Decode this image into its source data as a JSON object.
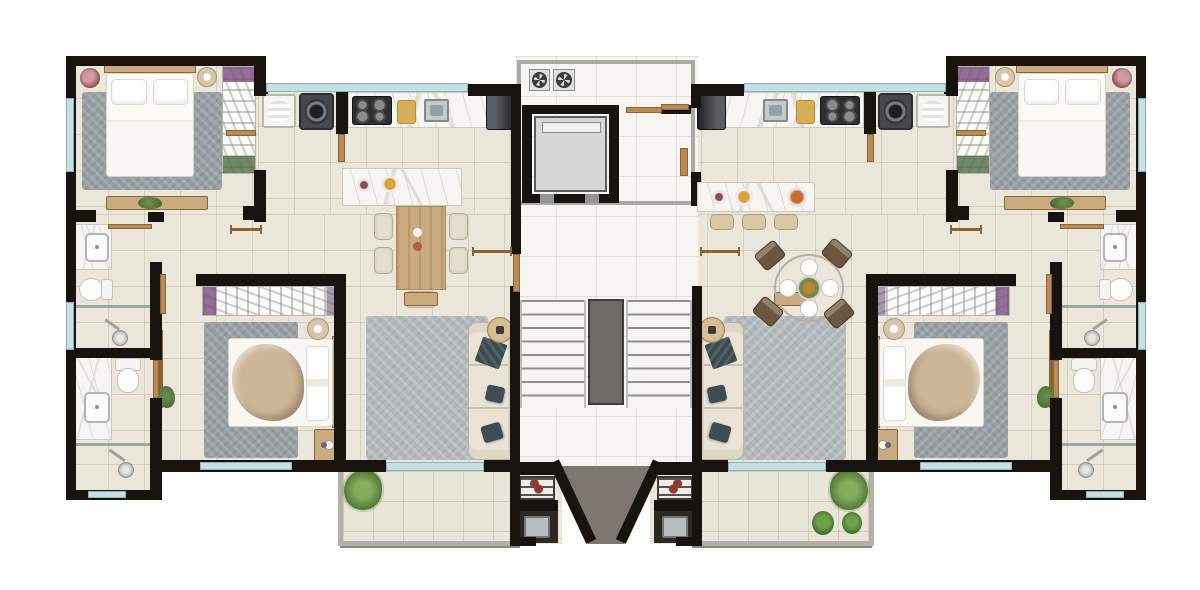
{
  "meta": {
    "canvas_w": 1200,
    "canvas_h": 590,
    "mirror_axis": 606,
    "description-data": "symmetric two-unit residential floor plan, central elevator and stair core"
  },
  "palette": {
    "wall": "#17140f",
    "floor": "#eae6da",
    "core": "#f6f5f2",
    "balc": "#e9e5d8",
    "balcFrame": "#b3b0aa",
    "window": "#c6dfe5",
    "windowFrame": "#8fb0b8",
    "wood": "#b88c54",
    "woodDark": "#8a6433",
    "woodLight": "#c9ab7f",
    "marble": "#f6f5f2",
    "marbleVein": "#d8d6d1",
    "rug": "#989ea1",
    "rugLight": "#b4b9bb",
    "sofa": "#e9e3d6",
    "pillowDark": "#3f4c51",
    "bedWhite": "#f8f7f4",
    "bedEdge": "#d8d4cb",
    "blanket": "#c2ab90",
    "taupe": "#7d7671",
    "plantGreen": "#6f9150",
    "plantDark": "#44622f",
    "grillRed": "#8d3a34"
  },
  "elements": [
    {
      "kind": "floor",
      "name": "floor-bedroom1",
      "x": 72,
      "y": 62,
      "w": 190,
      "h": 152
    },
    {
      "kind": "floor",
      "name": "floor-kitchen",
      "x": 258,
      "y": 90,
      "w": 258,
      "h": 126
    },
    {
      "kind": "floor",
      "name": "floor-mid",
      "x": 72,
      "y": 214,
      "w": 444,
      "h": 250
    },
    {
      "kind": "floor",
      "name": "floor-bath-ext",
      "x": 72,
      "y": 464,
      "w": 86,
      "h": 30
    },
    {
      "kind": "floor",
      "name": "floor-bbq-nook",
      "x": 516,
      "y": 466,
      "w": 46,
      "h": 78
    },
    {
      "kind": "core",
      "name": "floor-core",
      "x": 516,
      "y": 56,
      "w": 182,
      "h": 410,
      "m": false
    },
    {
      "kind": "balc",
      "name": "balcony",
      "x": 338,
      "y": 466,
      "w": 180,
      "h": 80
    },
    {
      "kind": "taupe",
      "name": "terrace-left",
      "x": 552,
      "y": 466,
      "w": 56,
      "h": 78,
      "m": false,
      "clip": "polygon(0 0,100% 0,100% 100%,64% 100%)"
    },
    {
      "kind": "taupe",
      "name": "terrace-right",
      "x": 604,
      "y": 466,
      "w": 56,
      "h": 78,
      "m": false,
      "clip": "polygon(0 0,100% 0,36% 100%,0 100%)"
    },
    {
      "kind": "shaft",
      "name": "elevator-shaft-frame",
      "x": 517,
      "y": 60,
      "w": 178,
      "h": 145,
      "m": false
    },
    {
      "kind": "flight",
      "name": "stair-flight",
      "x": 520,
      "y": 300,
      "w": 66,
      "h": 108
    },
    {
      "kind": "rail",
      "name": "stair-rail",
      "x": 588,
      "y": 299,
      "w": 36,
      "h": 106,
      "m": false
    },
    {
      "kind": "rug",
      "name": "rug-bedroom1",
      "x": 82,
      "y": 92,
      "w": 140,
      "h": 98
    },
    {
      "kind": "headh",
      "name": "bed1-headboard",
      "x": 104,
      "y": 64,
      "w": 92,
      "h": 9
    },
    {
      "kind": "bedv",
      "name": "bed-double",
      "x": 106,
      "y": 73,
      "w": 88,
      "h": 104
    },
    {
      "kind": "wardv",
      "name": "wardrobe-bedroom1",
      "x": 222,
      "y": 66,
      "w": 34,
      "h": 108
    },
    {
      "kind": "plantpot",
      "name": "flower-pot",
      "x": 80,
      "y": 68,
      "w": 20,
      "h": 20
    },
    {
      "kind": "lamp",
      "name": "bedside-lamp1",
      "x": 197,
      "y": 67,
      "w": 20,
      "h": 20
    },
    {
      "kind": "dresser",
      "name": "dresser-bedroom1",
      "x": 106,
      "y": 196,
      "w": 102,
      "h": 14
    },
    {
      "kind": "plant",
      "name": "dresser-plant",
      "x": 138,
      "y": 197,
      "w": 24,
      "h": 12
    },
    {
      "kind": "tank",
      "name": "laundry-tank",
      "x": 262,
      "y": 94,
      "w": 34,
      "h": 34
    },
    {
      "kind": "washer",
      "name": "washing-machine",
      "x": 299,
      "y": 93,
      "w": 35,
      "h": 37
    },
    {
      "kind": "counter",
      "name": "kitchen-counter",
      "x": 348,
      "y": 92,
      "w": 166,
      "h": 36
    },
    {
      "kind": "stove",
      "name": "cooktop",
      "x": 352,
      "y": 96,
      "w": 40,
      "h": 29
    },
    {
      "kind": "board",
      "name": "cutting-board",
      "x": 397,
      "y": 100,
      "w": 19,
      "h": 24
    },
    {
      "kind": "sinks",
      "name": "kitchen-sink",
      "x": 424,
      "y": 99,
      "w": 25,
      "h": 23
    },
    {
      "kind": "fridge",
      "name": "fridge",
      "x": 486,
      "y": 91,
      "w": 29,
      "h": 39
    },
    {
      "kind": "island",
      "name": "kitchen-island",
      "x": 342,
      "y": 168,
      "w": 120,
      "h": 38,
      "m": false
    },
    {
      "kind": "table",
      "name": "dining-table",
      "x": 396,
      "y": 206,
      "w": 50,
      "h": 84,
      "m": false
    },
    {
      "kind": "chair",
      "name": "dining-chair",
      "x": 374,
      "y": 213,
      "w": 19,
      "h": 27,
      "m": false
    },
    {
      "kind": "chair",
      "name": "dining-chair",
      "x": 374,
      "y": 247,
      "w": 19,
      "h": 27,
      "m": false
    },
    {
      "kind": "chair",
      "name": "dining-chair",
      "x": 449,
      "y": 213,
      "w": 19,
      "h": 27,
      "m": false
    },
    {
      "kind": "chair",
      "name": "dining-chair",
      "x": 449,
      "y": 247,
      "w": 19,
      "h": 27,
      "m": false
    },
    {
      "kind": "chair",
      "name": "dining-chair",
      "x": 405,
      "y": 291,
      "w": 31,
      "h": 17,
      "m": false
    },
    {
      "kind": "vanity",
      "name": "vanity-bath1",
      "x": 75,
      "y": 224,
      "w": 37,
      "h": 46
    },
    {
      "kind": "sinkw",
      "name": "sink-bath1",
      "x": 85,
      "y": 233,
      "w": 24,
      "h": 29
    },
    {
      "kind": "toileth",
      "name": "toilet-bath1",
      "x": 79,
      "y": 276,
      "w": 34,
      "h": 25
    },
    {
      "kind": "glass",
      "name": "shower-glass1",
      "x": 75,
      "y": 305,
      "w": 76,
      "h": 3
    },
    {
      "kind": "shower",
      "name": "shower-head1",
      "x": 102,
      "y": 320,
      "w": 28,
      "h": 28
    },
    {
      "kind": "vanity",
      "name": "vanity-bath2",
      "x": 75,
      "y": 356,
      "w": 37,
      "h": 84
    },
    {
      "kind": "sinkw",
      "name": "sink-bath2",
      "x": 84,
      "y": 392,
      "w": 26,
      "h": 31
    },
    {
      "kind": "toiletv",
      "name": "toilet-bath2",
      "x": 112,
      "y": 358,
      "w": 30,
      "h": 35
    },
    {
      "kind": "glass",
      "name": "shower-glass2",
      "x": 75,
      "y": 443,
      "w": 80,
      "h": 3
    },
    {
      "kind": "shower",
      "name": "shower-head2",
      "x": 106,
      "y": 450,
      "w": 30,
      "h": 30
    },
    {
      "kind": "wardh",
      "name": "wardrobe-bedroom2",
      "x": 202,
      "y": 286,
      "w": 136,
      "h": 30
    },
    {
      "kind": "rug",
      "name": "rug-bedroom2",
      "x": 204,
      "y": 322,
      "w": 94,
      "h": 136
    },
    {
      "kind": "headv",
      "name": "bed2-headboard",
      "x": 332,
      "y": 336,
      "w": 9,
      "h": 92
    },
    {
      "kind": "bedh",
      "name": "bed-double2",
      "x": 228,
      "y": 338,
      "w": 105,
      "h": 89
    },
    {
      "kind": "lamp",
      "name": "bedside-lamp2",
      "x": 307,
      "y": 318,
      "w": 22,
      "h": 22
    },
    {
      "kind": "nightstand",
      "name": "nightstand-bedroom2",
      "x": 314,
      "y": 429,
      "w": 26,
      "h": 33
    },
    {
      "kind": "tvpanel",
      "name": "tv-panel",
      "x": 157,
      "y": 330,
      "w": 6,
      "h": 78
    },
    {
      "kind": "plant",
      "name": "bedroom2-plant",
      "x": 158,
      "y": 386,
      "w": 17,
      "h": 22
    },
    {
      "kind": "tvstand",
      "name": "tv-stand-living",
      "x": 404,
      "y": 292,
      "w": 34,
      "h": 14
    },
    {
      "kind": "ruglight",
      "name": "rug-living",
      "x": 366,
      "y": 316,
      "w": 122,
      "h": 144
    },
    {
      "kind": "sofa",
      "name": "sofa",
      "x": 468,
      "y": 322,
      "w": 50,
      "h": 138
    },
    {
      "kind": "throw",
      "name": "sofa-throw",
      "x": 478,
      "y": 340,
      "w": 26,
      "h": 26,
      "rot": 20
    },
    {
      "kind": "pillow",
      "name": "sofa-pillow",
      "x": 486,
      "y": 386,
      "w": 18,
      "h": 16,
      "rot": 12
    },
    {
      "kind": "pillow",
      "name": "sofa-pillow",
      "x": 482,
      "y": 424,
      "w": 20,
      "h": 17,
      "rot": -16
    },
    {
      "kind": "sidetable",
      "name": "side-table",
      "x": 487,
      "y": 317,
      "w": 26,
      "h": 26
    },
    {
      "kind": "fern",
      "name": "balcony-fern",
      "x": 344,
      "y": 470,
      "w": 38,
      "h": 40
    },
    {
      "kind": "bbq",
      "name": "bbq-grill",
      "x": 519,
      "y": 476,
      "w": 36,
      "h": 24
    },
    {
      "kind": "bbqsink",
      "name": "bbq-sink",
      "x": 516,
      "y": 511,
      "w": 42,
      "h": 32
    },
    {
      "kind": "fan",
      "name": "exhaust-fan",
      "x": 529,
      "y": 69,
      "w": 21,
      "h": 22,
      "m": false
    },
    {
      "kind": "fan",
      "name": "exhaust-fan",
      "x": 553,
      "y": 69,
      "w": 22,
      "h": 22,
      "m": false
    },
    {
      "kind": "car",
      "name": "elevator-car",
      "x": 534,
      "y": 116,
      "w": 73,
      "h": 76,
      "m": false
    },
    {
      "kind": "wall",
      "name": "wall",
      "x": 66,
      "y": 56,
      "w": 198,
      "h": 10
    },
    {
      "kind": "wall",
      "name": "wall",
      "x": 66,
      "y": 56,
      "w": 10,
      "h": 160
    },
    {
      "kind": "wall",
      "name": "wall",
      "x": 254,
      "y": 56,
      "w": 12,
      "h": 40
    },
    {
      "kind": "wall",
      "name": "wall",
      "x": 254,
      "y": 170,
      "w": 12,
      "h": 52
    },
    {
      "kind": "wall",
      "name": "wall",
      "x": 258,
      "y": 84,
      "w": 10,
      "h": 10
    },
    {
      "kind": "wall",
      "name": "wall",
      "x": 468,
      "y": 84,
      "w": 50,
      "h": 12
    },
    {
      "kind": "wall",
      "name": "wall",
      "x": 66,
      "y": 210,
      "w": 30,
      "h": 12
    },
    {
      "kind": "wall",
      "name": "wall",
      "x": 148,
      "y": 212,
      "w": 16,
      "h": 10
    },
    {
      "kind": "wall",
      "name": "wall",
      "x": 243,
      "y": 206,
      "w": 23,
      "h": 14
    },
    {
      "kind": "wall",
      "name": "wall",
      "x": 336,
      "y": 86,
      "w": 12,
      "h": 48
    },
    {
      "kind": "wall",
      "name": "corridor-wall-left",
      "x": 511,
      "y": 84,
      "w": 10,
      "h": 170,
      "m": false
    },
    {
      "kind": "wall",
      "name": "corridor-wall-right",
      "x": 691,
      "y": 84,
      "w": 10,
      "h": 24,
      "m": false
    },
    {
      "kind": "wall",
      "name": "corridor-wall-right",
      "x": 691,
      "y": 172,
      "w": 10,
      "h": 34,
      "m": false
    },
    {
      "kind": "wall",
      "name": "stair-wall",
      "x": 510,
      "y": 286,
      "w": 10,
      "h": 186
    },
    {
      "kind": "wall",
      "name": "wall",
      "x": 66,
      "y": 348,
      "w": 94,
      "h": 10
    },
    {
      "kind": "wall",
      "name": "wall",
      "x": 66,
      "y": 216,
      "w": 10,
      "h": 136
    },
    {
      "kind": "wall",
      "name": "wall",
      "x": 66,
      "y": 352,
      "w": 10,
      "h": 148
    },
    {
      "kind": "wall",
      "name": "wall",
      "x": 150,
      "y": 262,
      "w": 12,
      "h": 98
    },
    {
      "kind": "wall",
      "name": "wall",
      "x": 150,
      "y": 398,
      "w": 12,
      "h": 102
    },
    {
      "kind": "wall",
      "name": "wall",
      "x": 66,
      "y": 490,
      "w": 96,
      "h": 10
    },
    {
      "kind": "wall",
      "name": "wall",
      "x": 196,
      "y": 274,
      "w": 150,
      "h": 12
    },
    {
      "kind": "wall",
      "name": "wall",
      "x": 334,
      "y": 274,
      "w": 12,
      "h": 192
    },
    {
      "kind": "wall",
      "name": "wall",
      "x": 156,
      "y": 460,
      "w": 190,
      "h": 12
    },
    {
      "kind": "wall",
      "name": "wall",
      "x": 344,
      "y": 460,
      "w": 42,
      "h": 12
    },
    {
      "kind": "wall",
      "name": "wall",
      "x": 484,
      "y": 460,
      "w": 34,
      "h": 12
    },
    {
      "kind": "wall",
      "name": "wall",
      "x": 510,
      "y": 462,
      "w": 48,
      "h": 13
    },
    {
      "kind": "wall",
      "name": "wall",
      "x": 510,
      "y": 460,
      "w": 10,
      "h": 85
    },
    {
      "kind": "wall",
      "name": "bbq-counter",
      "x": 510,
      "y": 500,
      "w": 48,
      "h": 11
    },
    {
      "kind": "wall",
      "name": "wall",
      "x": 510,
      "y": 537,
      "w": 26,
      "h": 9
    },
    {
      "kind": "wall",
      "name": "elevator-wall",
      "x": 522,
      "y": 105,
      "w": 97,
      "h": 9,
      "m": false
    },
    {
      "kind": "wall",
      "name": "elevator-wall",
      "x": 522,
      "y": 105,
      "w": 10,
      "h": 98,
      "m": false
    },
    {
      "kind": "wall",
      "name": "elevator-wall",
      "x": 609,
      "y": 105,
      "w": 10,
      "h": 98,
      "m": false
    },
    {
      "kind": "wall",
      "name": "elevator-wall",
      "x": 522,
      "y": 194,
      "w": 97,
      "h": 9,
      "m": false
    },
    {
      "kind": "sill",
      "name": "elevator-door-sill",
      "x": 540,
      "y": 194,
      "w": 14,
      "h": 9,
      "m": false
    },
    {
      "kind": "sill",
      "name": "elevator-door-sill",
      "x": 585,
      "y": 194,
      "w": 14,
      "h": 9,
      "m": false
    },
    {
      "kind": "wall",
      "name": "wall",
      "x": 661,
      "y": 105,
      "w": 30,
      "h": 9,
      "m": false
    },
    {
      "kind": "diag",
      "name": "angled-wall-left",
      "x": 549,
      "y": 464,
      "w": 11,
      "h": 88,
      "m": false,
      "rot": -25,
      "origin": "0 0"
    },
    {
      "kind": "diag",
      "name": "angled-wall-right",
      "x": 652,
      "y": 464,
      "w": 11,
      "h": 88,
      "m": false,
      "rot": 25,
      "origin": "100% 0"
    },
    {
      "kind": "window",
      "name": "window-bedroom1",
      "x": 66,
      "y": 98,
      "w": 8,
      "h": 74
    },
    {
      "kind": "window",
      "name": "window-kitchen",
      "x": 266,
      "y": 83,
      "w": 202,
      "h": 9
    },
    {
      "kind": "window",
      "name": "window-bath1",
      "x": 66,
      "y": 302,
      "w": 8,
      "h": 48
    },
    {
      "kind": "window",
      "name": "window-bath2",
      "x": 88,
      "y": 491,
      "w": 38,
      "h": 7
    },
    {
      "kind": "window",
      "name": "window-bedroom2",
      "x": 200,
      "y": 462,
      "w": 92,
      "h": 8
    },
    {
      "kind": "window",
      "name": "sliding-door-living",
      "x": 386,
      "y": 462,
      "w": 98,
      "h": 9
    },
    {
      "kind": "door",
      "name": "door-leaf-bath1",
      "x": 108,
      "y": 224,
      "w": 44,
      "h": 5
    },
    {
      "kind": "swing",
      "name": "door-swing-mark",
      "x": 230,
      "y": 228,
      "w": 32,
      "h": 3
    },
    {
      "kind": "door",
      "name": "door-leaf-bedroom1",
      "x": 226,
      "y": 130,
      "w": 30,
      "h": 6
    },
    {
      "kind": "door",
      "name": "door-leaf-laundry",
      "x": 338,
      "y": 134,
      "w": 7,
      "h": 28
    },
    {
      "kind": "door",
      "name": "door-leaf-bedroom2",
      "x": 160,
      "y": 274,
      "w": 6,
      "h": 40
    },
    {
      "kind": "door",
      "name": "door-leaf-bath2",
      "x": 153,
      "y": 360,
      "w": 6,
      "h": 38
    },
    {
      "kind": "swing",
      "name": "door-swing-mark",
      "x": 472,
      "y": 250,
      "w": 40,
      "h": 3
    },
    {
      "kind": "door",
      "name": "entry-door-left-unit",
      "x": 513,
      "y": 254,
      "w": 7,
      "h": 38,
      "m": false
    },
    {
      "kind": "door",
      "name": "hall-door",
      "x": 626,
      "y": 107,
      "w": 36,
      "h": 6,
      "m": false
    },
    {
      "kind": "door",
      "name": "entry-door-right-unit",
      "x": 661,
      "y": 104,
      "w": 28,
      "h": 6,
      "m": false
    },
    {
      "kind": "door",
      "name": "door-jamb-right-unit",
      "x": 680,
      "y": 148,
      "w": 8,
      "h": 28,
      "m": false
    },
    {
      "kind": "island",
      "name": "kitchen-island-right",
      "x": 697,
      "y": 182,
      "w": 118,
      "h": 30,
      "m": false
    },
    {
      "kind": "bowl",
      "name": "fruit-bowl",
      "x": 787,
      "y": 187,
      "w": 20,
      "h": 20,
      "m": false
    },
    {
      "kind": "stool",
      "name": "bar-stool",
      "x": 710,
      "y": 214,
      "w": 24,
      "h": 16,
      "m": false
    },
    {
      "kind": "stool",
      "name": "bar-stool",
      "x": 742,
      "y": 214,
      "w": 24,
      "h": 16,
      "m": false
    },
    {
      "kind": "stool",
      "name": "bar-stool",
      "x": 774,
      "y": 214,
      "w": 24,
      "h": 16,
      "m": false
    },
    {
      "kind": "rtable",
      "name": "round-dining-table",
      "x": 774,
      "y": 254,
      "w": 70,
      "h": 68,
      "m": false
    },
    {
      "kind": "rchair",
      "name": "round-table-chair",
      "x": 757,
      "y": 245,
      "w": 26,
      "h": 21,
      "m": false,
      "rot": -40
    },
    {
      "kind": "rchair",
      "name": "round-table-chair",
      "x": 824,
      "y": 243,
      "w": 26,
      "h": 21,
      "m": false,
      "rot": 40
    },
    {
      "kind": "rchair",
      "name": "round-table-chair",
      "x": 755,
      "y": 301,
      "w": 26,
      "h": 21,
      "m": false,
      "rot": 40
    },
    {
      "kind": "rchair",
      "name": "round-table-chair",
      "x": 826,
      "y": 303,
      "w": 26,
      "h": 21,
      "m": false,
      "rot": -40
    },
    {
      "kind": "palm",
      "name": "balcony-palm",
      "x": 812,
      "y": 511,
      "w": 22,
      "h": 24,
      "m": false
    },
    {
      "kind": "palm",
      "name": "balcony-palm",
      "x": 842,
      "y": 512,
      "w": 20,
      "h": 22,
      "m": false
    }
  ]
}
